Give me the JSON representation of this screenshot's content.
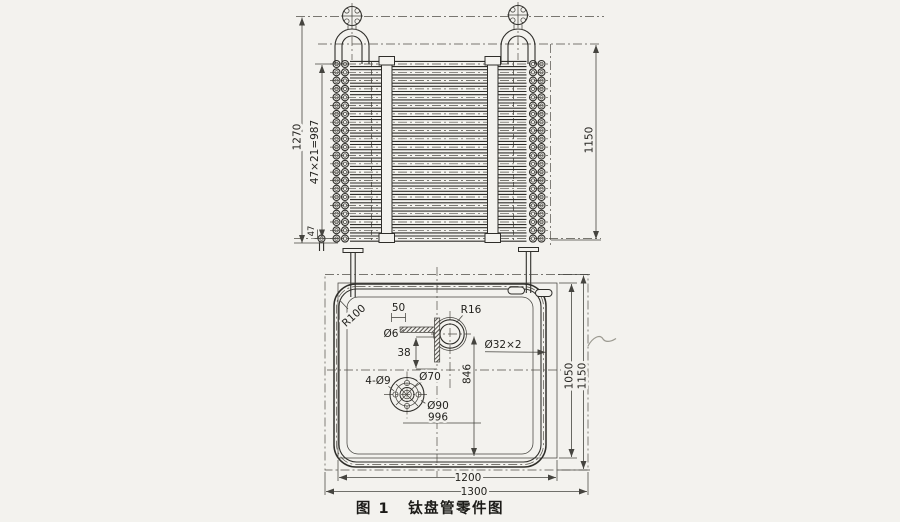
{
  "figure_caption": {
    "fig_no": "图 1",
    "title": "钛盘管零件图"
  },
  "top_view": {
    "tube_rows": 22,
    "dims": {
      "overall_height": "1270",
      "tube_pitch": "47×21=987",
      "last_pitch": "47",
      "inner_height": "1150"
    }
  },
  "plan_view": {
    "dims": {
      "corner_radius": "R100",
      "offset_50": "50",
      "drain_hole": "Ø6",
      "offset_38": "38",
      "bend_radius": "R16",
      "tube_spec": "Ø32×2",
      "offset_846": "846",
      "flange_holes": "4-Ø9",
      "bolt_circle": "Ø70",
      "flange_dia": "Ø90",
      "width_996": "996",
      "height_1050": "1050",
      "height_1150": "1150",
      "width_1200": "1200",
      "width_1300": "1300"
    }
  }
}
